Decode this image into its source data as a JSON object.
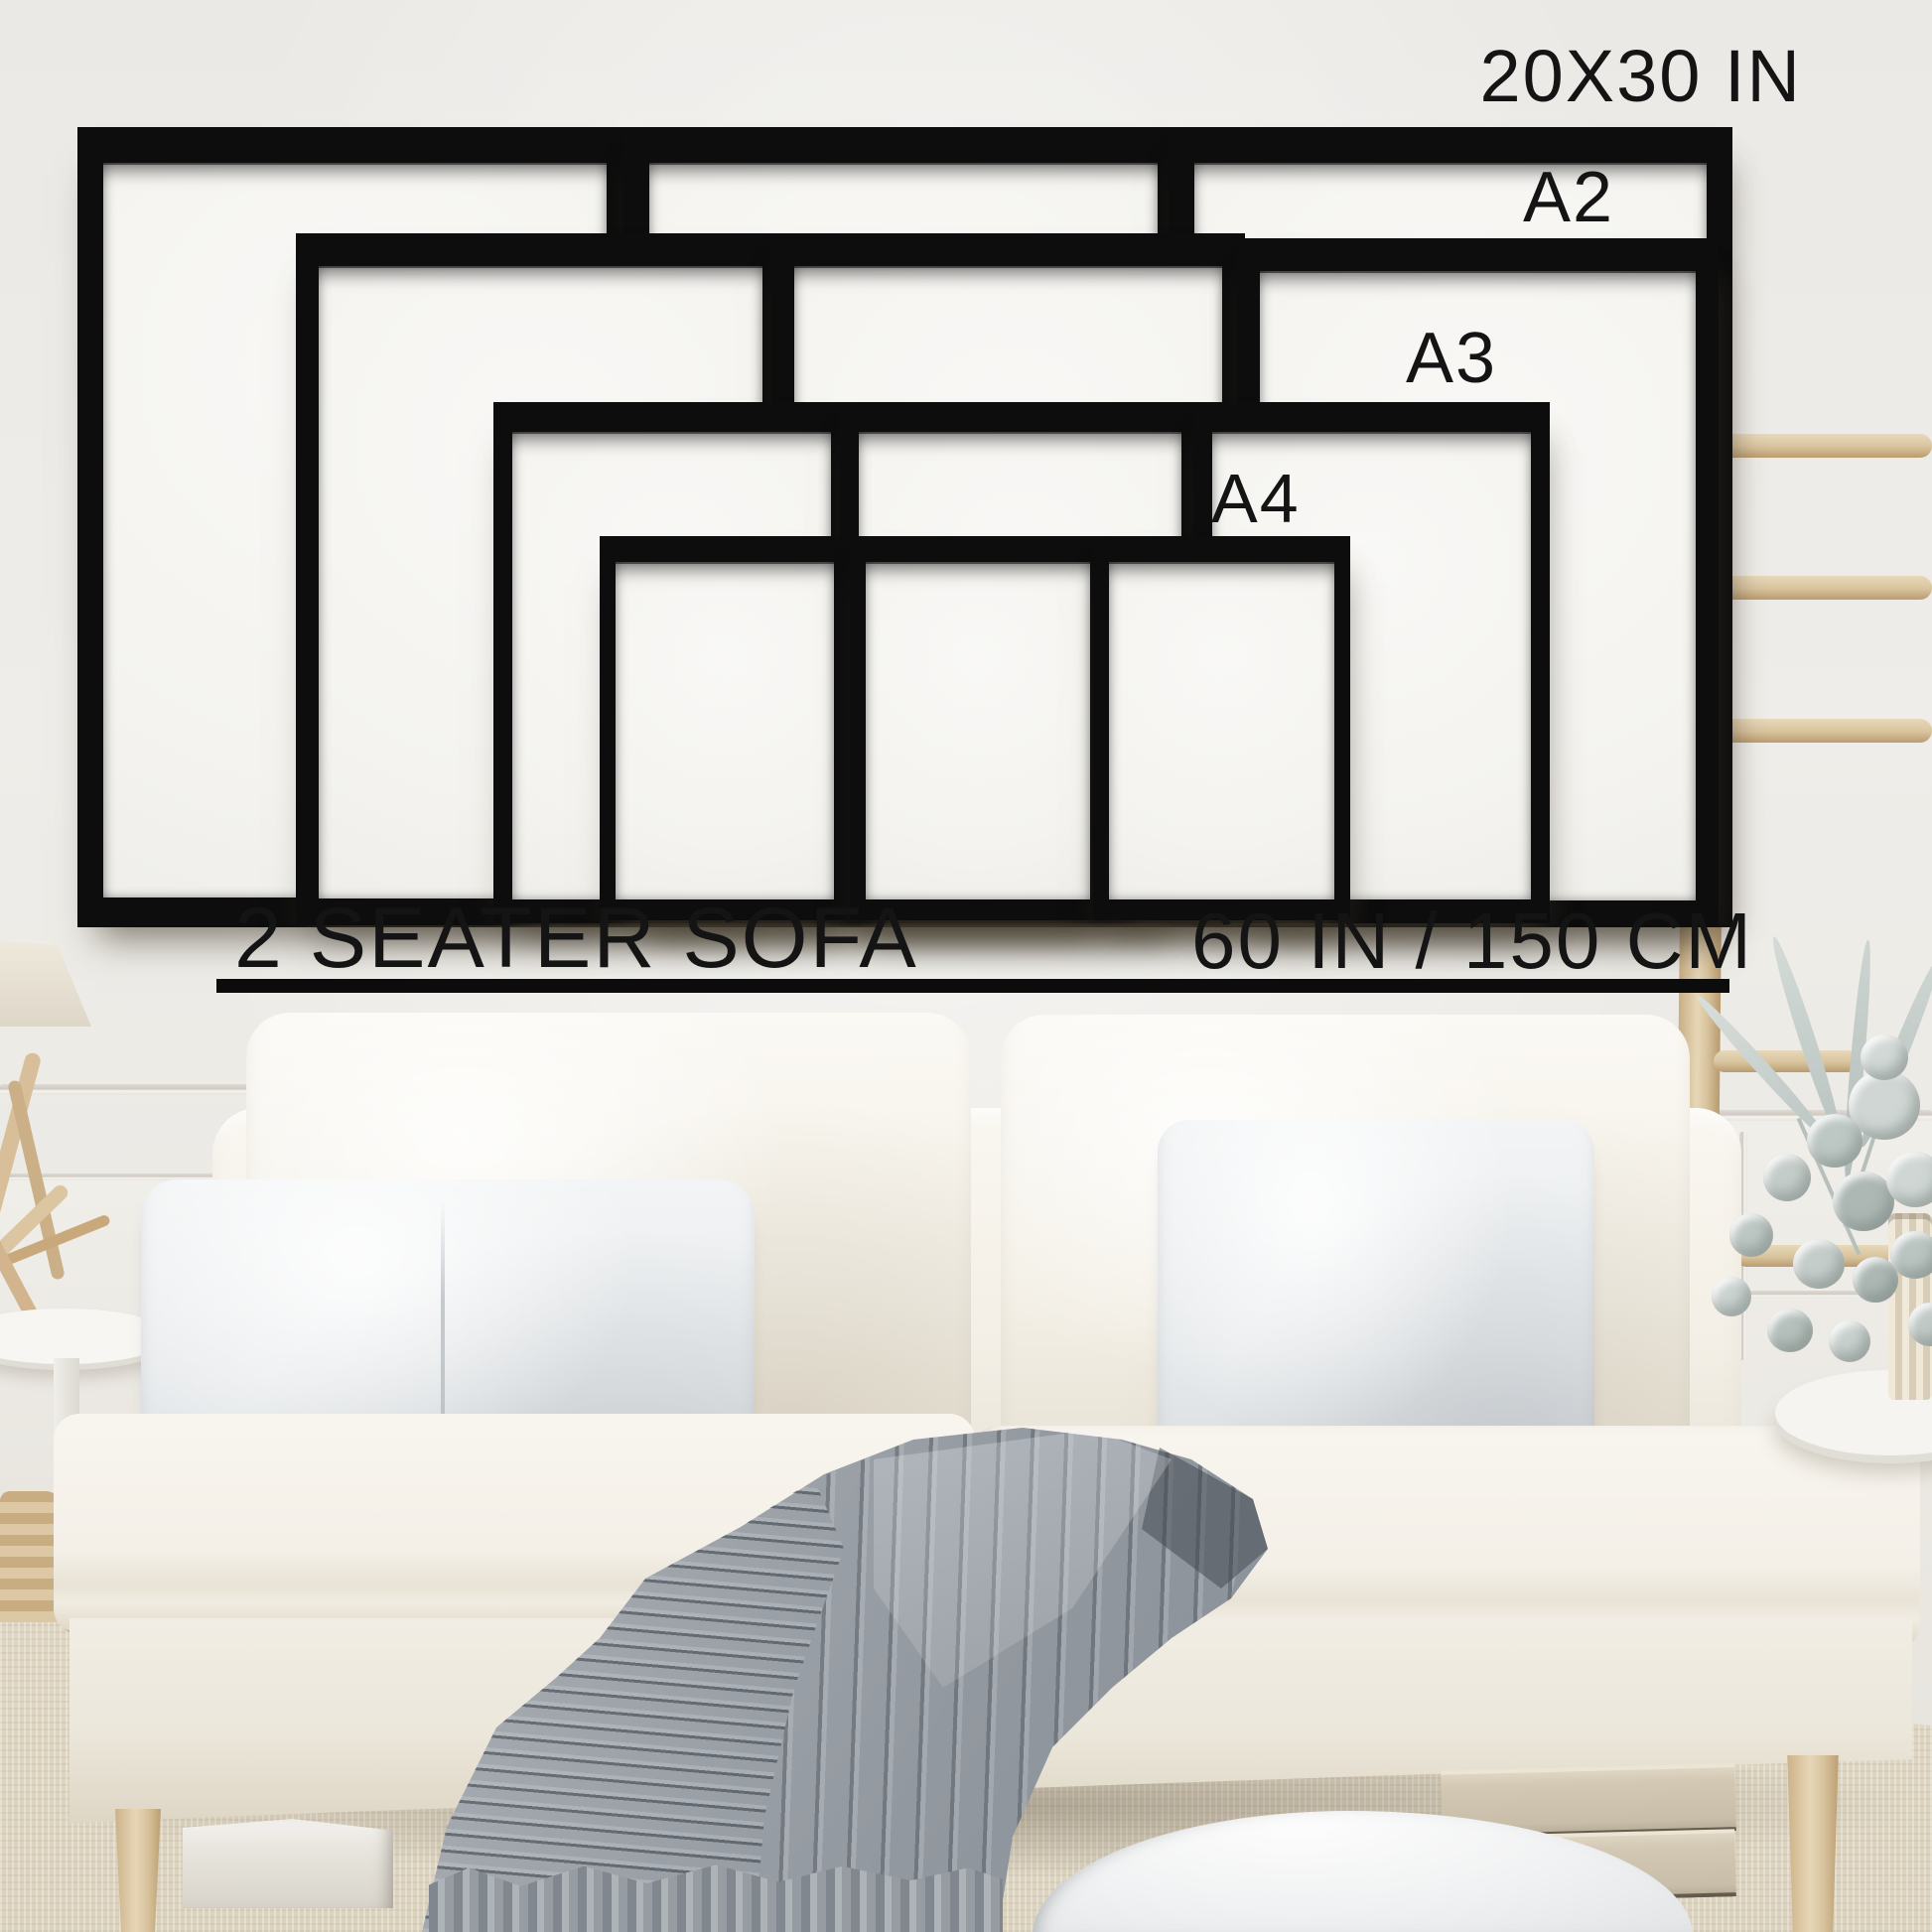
{
  "annotations": {
    "largest_size": "20X30 IN",
    "size_a2": "A2",
    "size_a3": "A3",
    "size_a4": "A4",
    "sofa_label": "2 SEATER SOFA",
    "sofa_width": "60 IN / 150 CM"
  },
  "frames": [
    {
      "size": "20X30 IN",
      "position": "back-left"
    },
    {
      "size": "20X30 IN",
      "position": "back-center"
    },
    {
      "size": "20X30 IN",
      "position": "back-right"
    },
    {
      "size": "A2",
      "position": "middle-left"
    },
    {
      "size": "A2",
      "position": "middle-center"
    },
    {
      "size": "A2",
      "position": "middle-right"
    },
    {
      "size": "A3",
      "position": "lower-left"
    },
    {
      "size": "A3",
      "position": "lower-center"
    },
    {
      "size": "A3",
      "position": "lower-right"
    },
    {
      "size": "A4",
      "position": "front-left"
    },
    {
      "size": "A4",
      "position": "front-center"
    },
    {
      "size": "A4",
      "position": "front-right"
    }
  ],
  "palette": {
    "annotation_text": "#141414",
    "frame_black": "#0d0d0d",
    "wall": "#edebe7",
    "mat_white": "#f6f5f2",
    "sofa_cream": "#f4f0e8",
    "pillow_gray": "#e9ecee",
    "blanket_gray": "#a7acb2",
    "wood": "#d9c5a2",
    "carpet": "#e7e0d0"
  }
}
